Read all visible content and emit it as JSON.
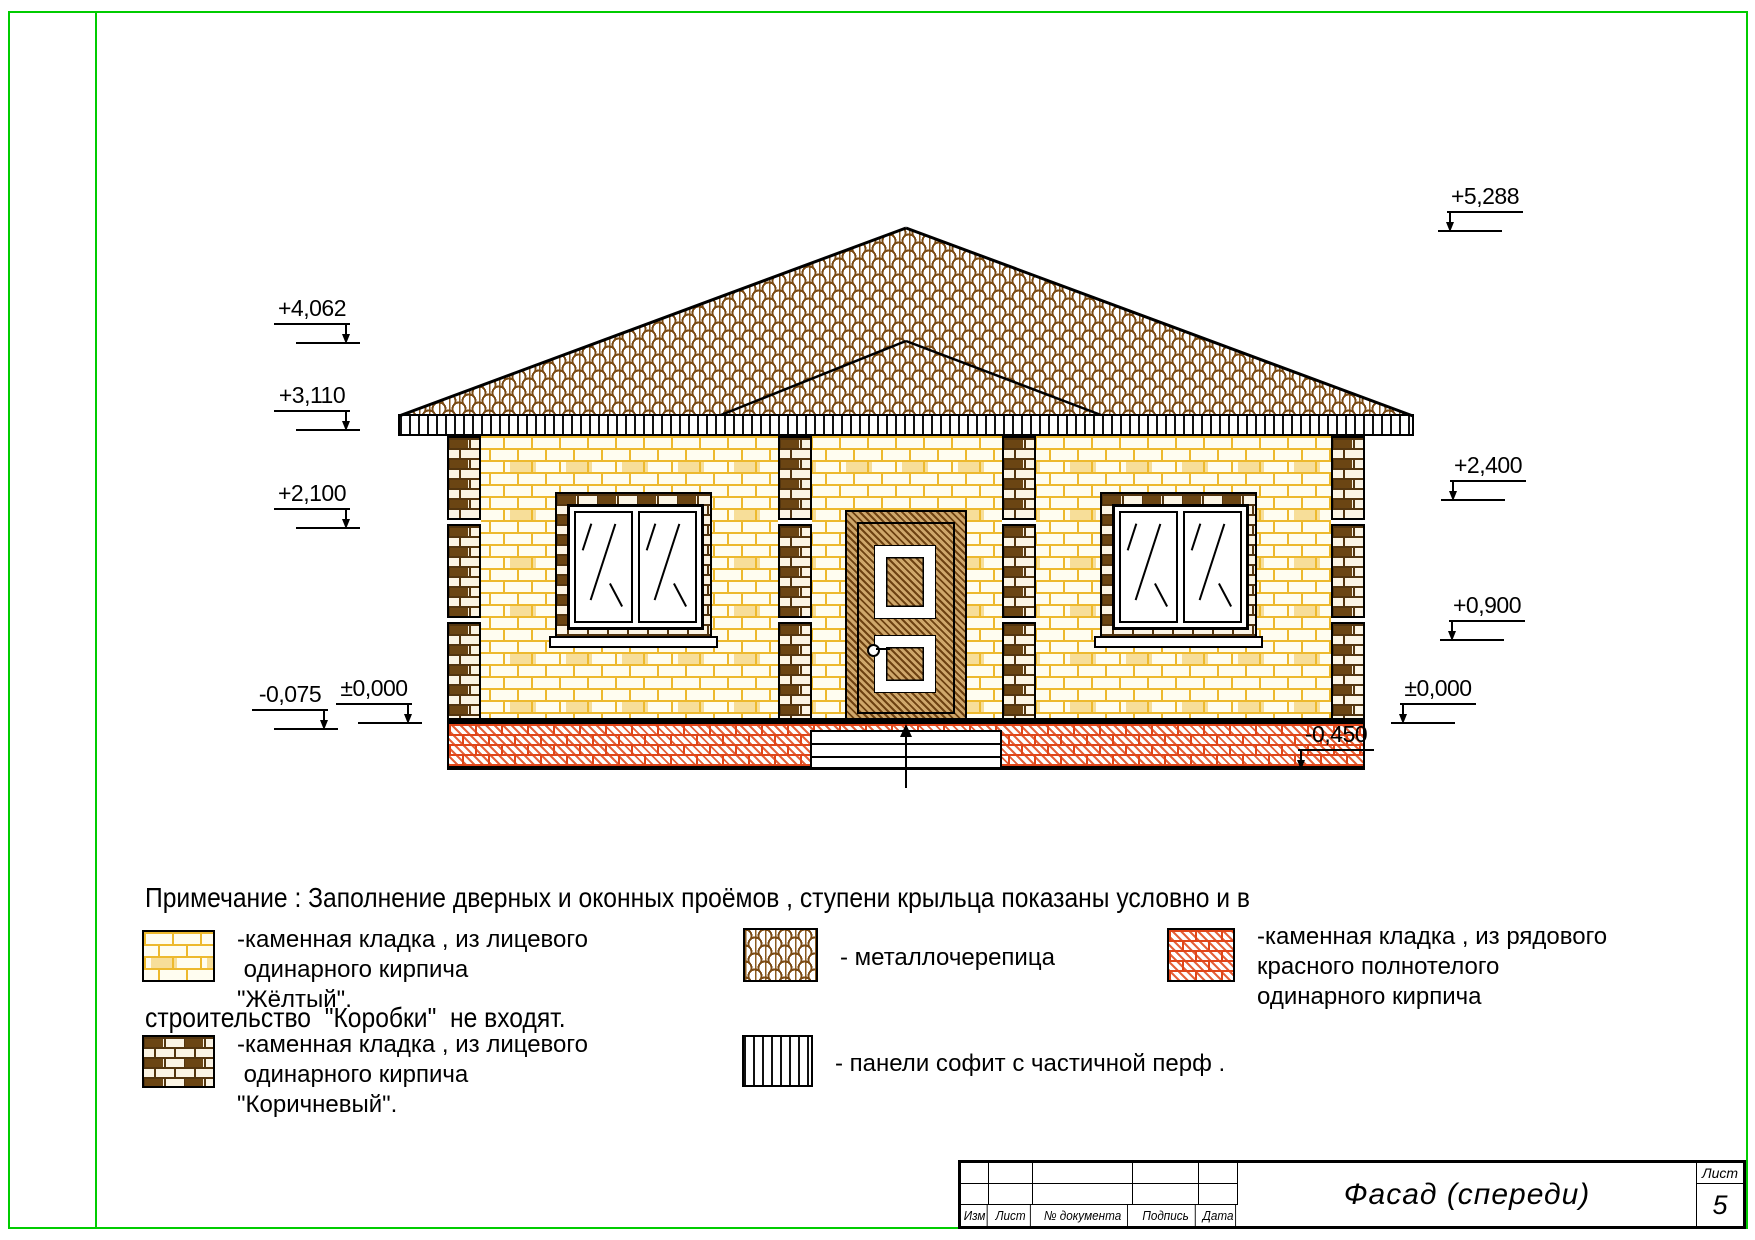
{
  "elevation_marks": {
    "left": [
      {
        "label": "+4,062"
      },
      {
        "label": "+3,110"
      },
      {
        "label": "+2,100"
      },
      {
        "label": "-0,075"
      },
      {
        "label": "±0,000"
      }
    ],
    "right": [
      {
        "label": "+5,288"
      },
      {
        "label": "+2,400"
      },
      {
        "label": "+0,900"
      },
      {
        "label": "±0,000"
      },
      {
        "label": "-0,450"
      }
    ]
  },
  "note": {
    "line1": "Примечание : Заполнение дверных и оконных проёмов , ступени крыльца показаны условно и в",
    "line2": "строительство  \"Коробки\"  не входят."
  },
  "legend": {
    "items": [
      {
        "id": "yellow-brick",
        "lines": [
          "-каменная кладка , из лицевого",
          " одинарного кирпича",
          "\"Жёлтый\"."
        ]
      },
      {
        "id": "brown-brick",
        "lines": [
          "-каменная кладка , из лицевого",
          " одинарного кирпича",
          "\"Коричневый\"."
        ]
      },
      {
        "id": "metal-tile",
        "lines": [
          "- металлочерепица"
        ]
      },
      {
        "id": "red-brick",
        "lines": [
          "-каменная кладка , из рядового",
          "красного полнотелого",
          "одинарного кирпича"
        ]
      },
      {
        "id": "soffit-panels",
        "lines": [
          "- панели софит с частичной перф ."
        ]
      }
    ]
  },
  "title_block": {
    "title": "Фасад (спереди)",
    "columns": [
      "Изм",
      "Лист",
      "№ документа",
      "Подпись",
      "Дата"
    ],
    "sheet_label": "Лист",
    "sheet_number": "5"
  },
  "colors": {
    "frame_green": "#00cc00",
    "yellow_brick": "#edb92e",
    "brown_brick": "#53350f",
    "red_brick": "#e04619",
    "roof_brown": "#7b4b14"
  }
}
